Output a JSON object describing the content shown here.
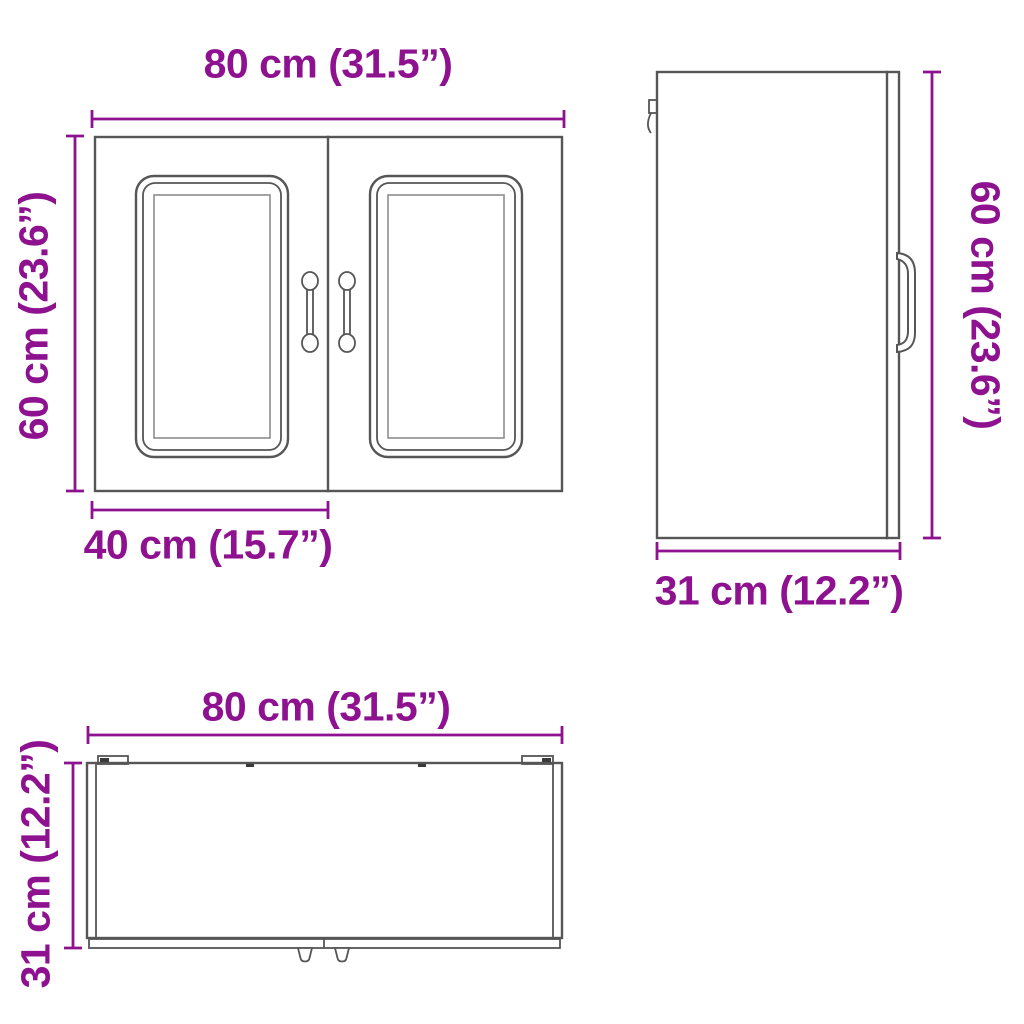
{
  "colors": {
    "dimension": "#8E1190",
    "outline": "#565656",
    "background": "#FFFFFF"
  },
  "views": {
    "front": {
      "width": "80 cm (31.5”)",
      "height": "60 cm (23.6”)",
      "door_width": "40 cm (15.7”)"
    },
    "side": {
      "height": "60 cm (23.6”)",
      "depth": "31 cm (12.2”)"
    },
    "top": {
      "width": "80 cm (31.5”)",
      "depth": "31 cm (12.2”)"
    }
  }
}
